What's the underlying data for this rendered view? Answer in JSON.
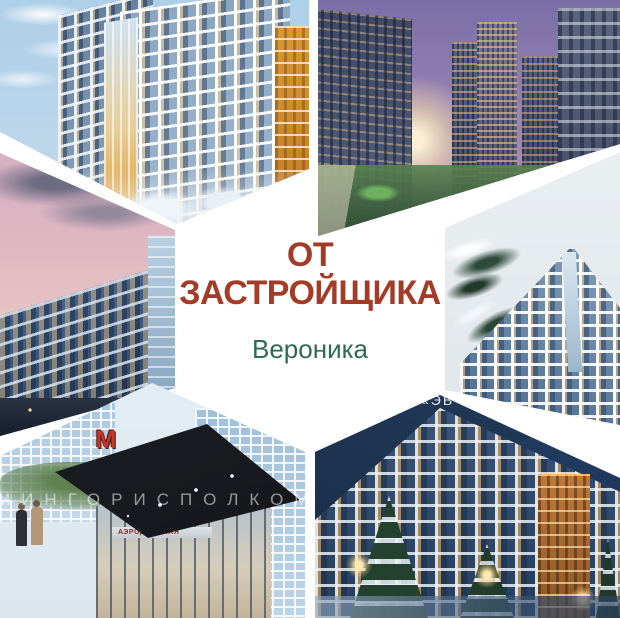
{
  "page": {
    "background": "#ffffff"
  },
  "hero": {
    "title_line1": "ОТ",
    "title_line2": "ЗАСТРОЙЩИКА",
    "title_color": "#a33b27",
    "subtitle": "Вероника",
    "subtitle_color": "#2e6b52"
  },
  "tiles": {
    "top_left": {
      "description": "Winter daytime render of white and blue apartment building with orange building at right and snowy trees"
    },
    "top_right": {
      "description": "Sunset cityscape render with three glass towers, low blocks and green landscaped courtyard"
    },
    "middle_left": {
      "description": "Blue glass apartment building at dusk under pink cloudy sky with street lights below"
    },
    "middle_right": {
      "description": "Blue and white apartment building with triangular prow under overcast sky, snowy pine branches"
    },
    "bottom_left": {
      "description": "Metro station entrance render with dark canopy and glass facade",
      "watermark": "МИНГОРИСПОЛКОМ",
      "metro_logo": "М",
      "station_name": "АЭРОДРОМНАЯ"
    },
    "bottom_right": {
      "description": "Apartment building at night with lit amber windows, snow-covered spruces and street lamps",
      "watermark": "«ЭВ"
    }
  }
}
